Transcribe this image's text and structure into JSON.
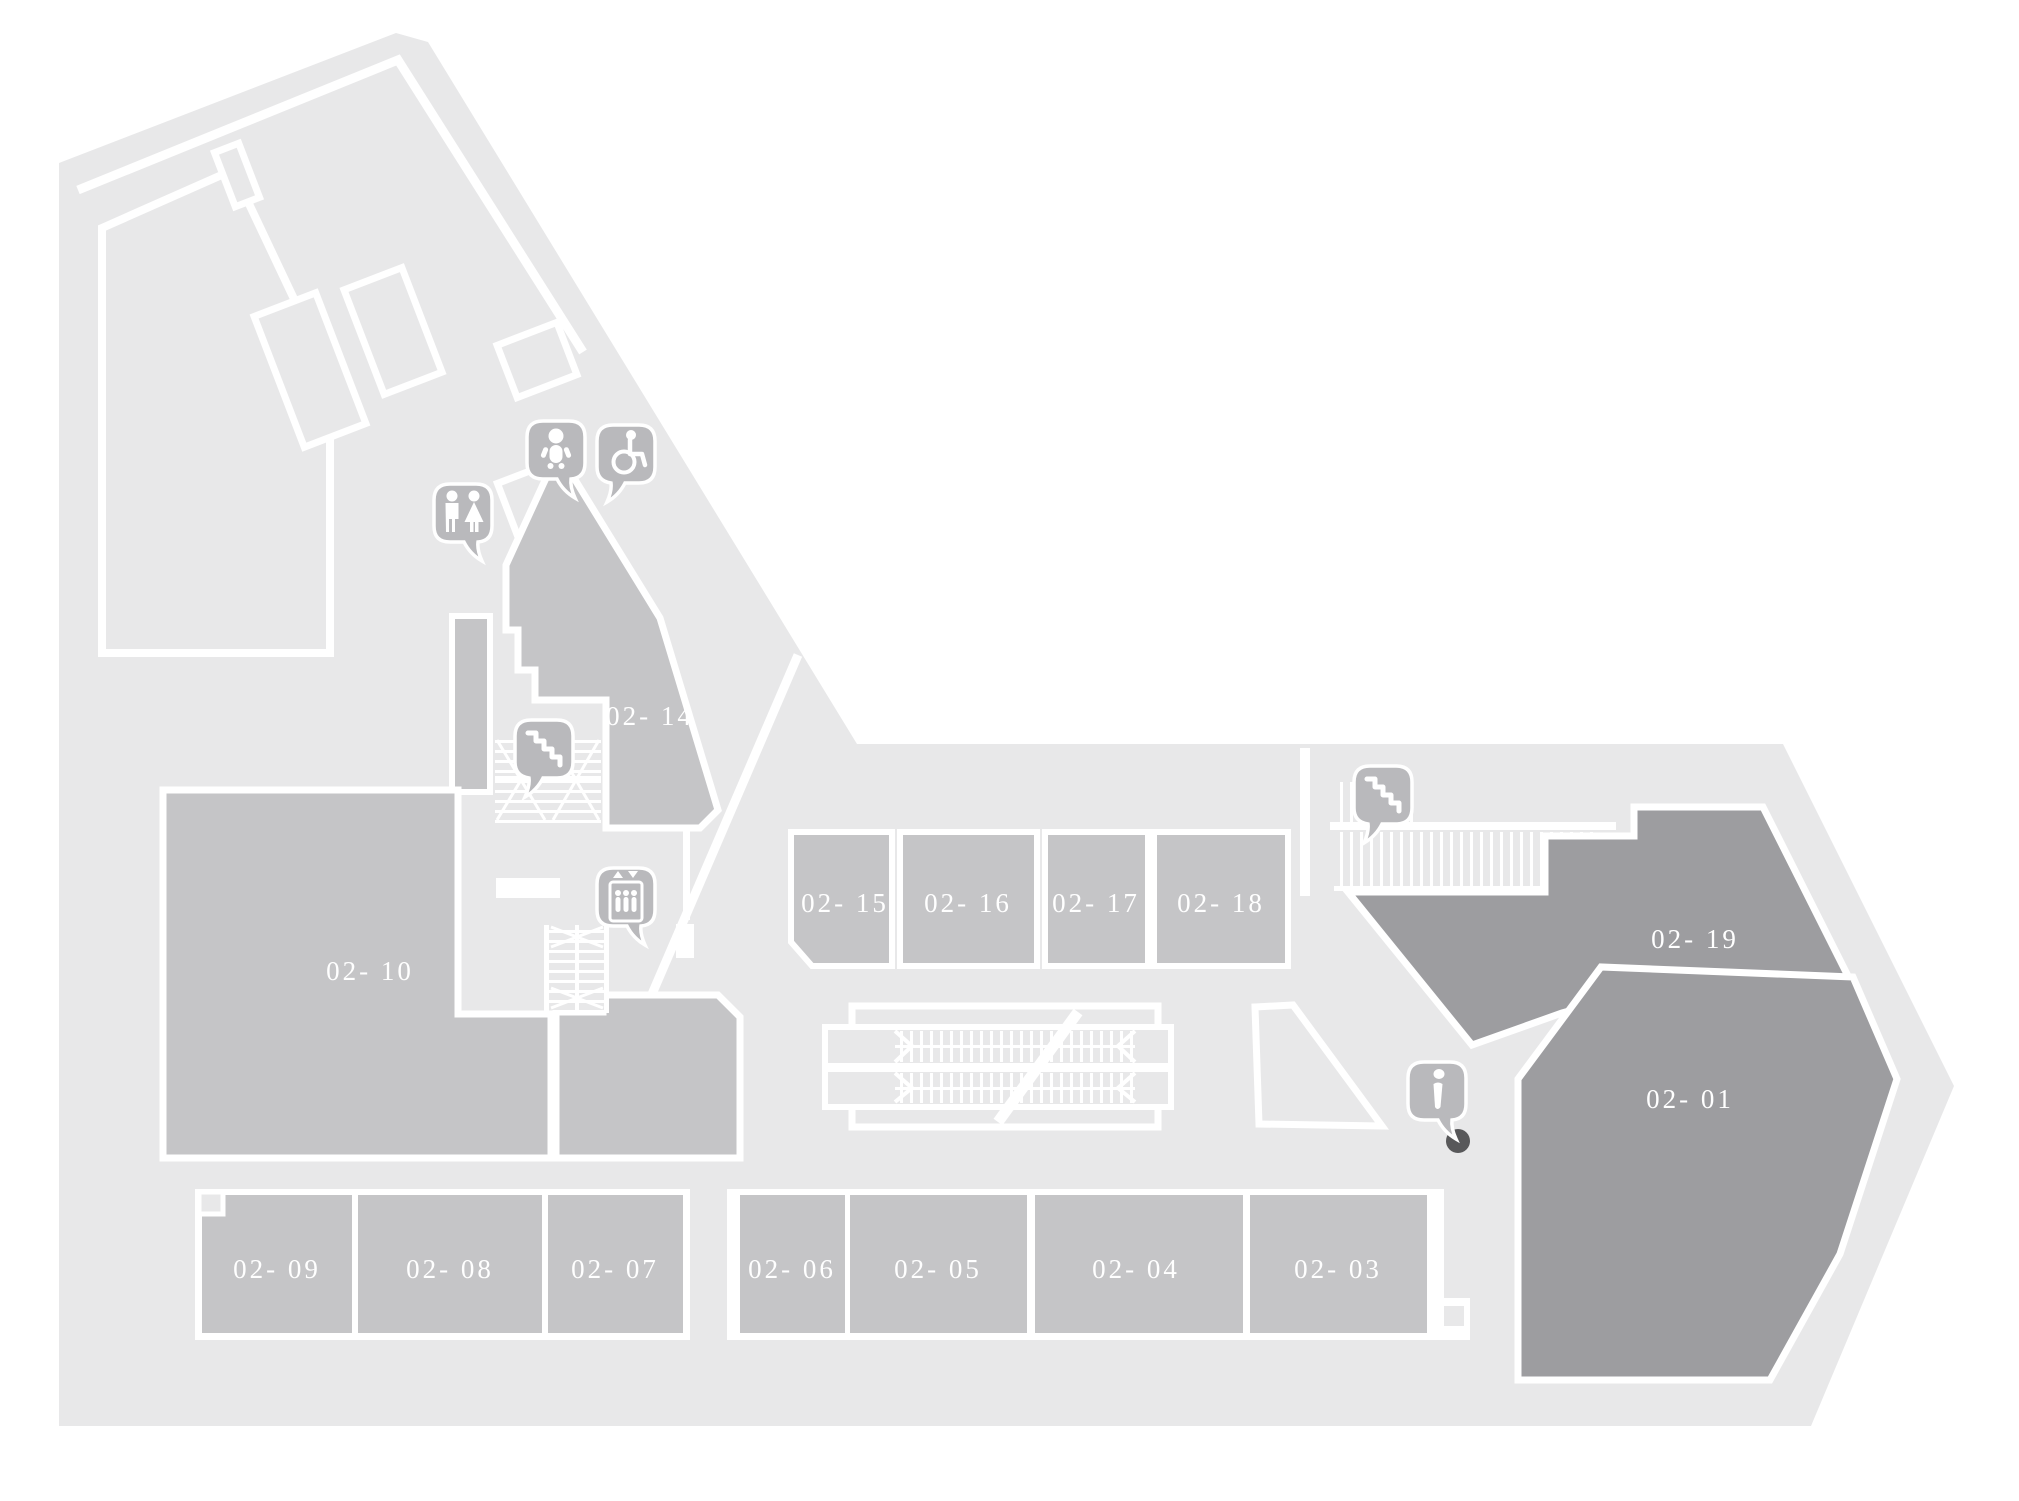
{
  "rooms": [
    {
      "id": "02-01",
      "label": "02- 01"
    },
    {
      "id": "02-03",
      "label": "02- 03"
    },
    {
      "id": "02-04",
      "label": "02- 04"
    },
    {
      "id": "02-05",
      "label": "02- 05"
    },
    {
      "id": "02-06",
      "label": "02- 06"
    },
    {
      "id": "02-07",
      "label": "02- 07"
    },
    {
      "id": "02-08",
      "label": "02- 08"
    },
    {
      "id": "02-09",
      "label": "02- 09"
    },
    {
      "id": "02-10",
      "label": "02- 10"
    },
    {
      "id": "02-14",
      "label": "02- 14"
    },
    {
      "id": "02-15",
      "label": "02- 15"
    },
    {
      "id": "02-16",
      "label": "02- 16"
    },
    {
      "id": "02-17",
      "label": "02- 17"
    },
    {
      "id": "02-18",
      "label": "02- 18"
    },
    {
      "id": "02-19",
      "label": "02- 19"
    }
  ],
  "icons": [
    {
      "name": "restrooms-icon"
    },
    {
      "name": "baby-care-icon"
    },
    {
      "name": "wheelchair-accessible-icon"
    },
    {
      "name": "stairs-west-icon"
    },
    {
      "name": "elevator-icon"
    },
    {
      "name": "stairs-east-icon"
    },
    {
      "name": "information-icon"
    }
  ],
  "colors": {
    "background": "#ffffff",
    "mall_floor": "#e8e8e9",
    "room_fill": "#c5c5c7",
    "room_dark_fill": "#9d9da0",
    "icon_bubble": "#b9b9bc",
    "label_text": "#ffffff",
    "marker_dot": "#58585a"
  }
}
